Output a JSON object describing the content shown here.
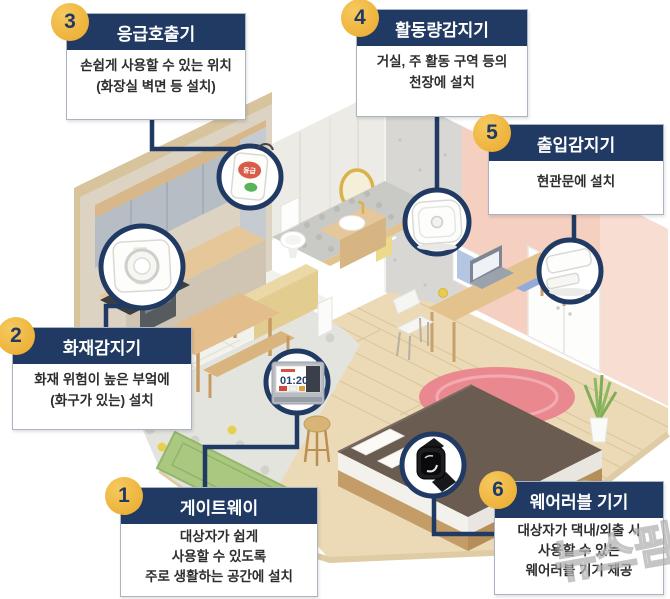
{
  "callouts": [
    {
      "number": "1",
      "title": "게이트웨이",
      "lines": [
        "대상자가 쉽게",
        "사용할 수 있도록",
        "주로 생활하는 공간에 설치"
      ]
    },
    {
      "number": "2",
      "title": "화재감지기",
      "lines": [
        "화재 위험이 높은 부엌에",
        "(화구가 있는) 설치"
      ]
    },
    {
      "number": "3",
      "title": "응급호출기",
      "lines": [
        "손쉽게 사용할 수 있는 위치",
        "(화장실 벽면 등 설치)"
      ]
    },
    {
      "number": "4",
      "title": "활동량감지기",
      "lines": [
        "거실, 주 활동 구역 등의",
        "천장에 설치"
      ]
    },
    {
      "number": "5",
      "title": "출입감지기",
      "lines": [
        "현관문에 설치"
      ]
    },
    {
      "number": "6",
      "title": "웨어러블 기기",
      "lines": [
        "대상자가 댁내/외출 시",
        "사용할 수 있는",
        "웨어러블 기기 제공"
      ]
    }
  ],
  "devices": {
    "gateway_screen_time": "01:20",
    "emergency_button_label": "응급"
  },
  "watermark": "뉴스핌",
  "colors": {
    "navy": "#213a63",
    "badge_yellow": "#eaa92c",
    "wall_pink": "#f5cfc0",
    "rug_red": "#e9898f",
    "mat_green": "#aac87f",
    "wood_floor": "#ecdab6"
  }
}
